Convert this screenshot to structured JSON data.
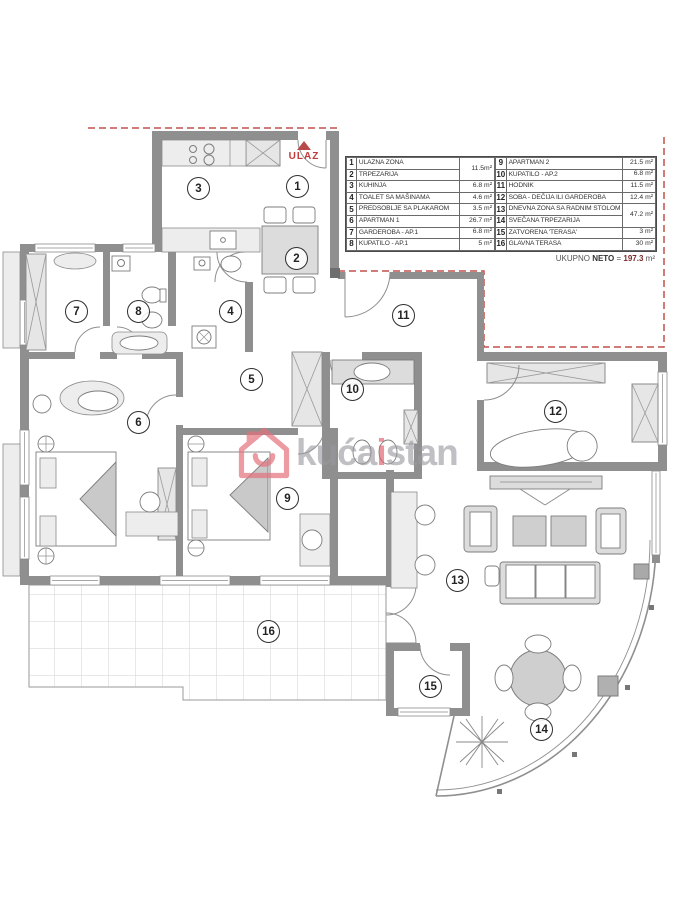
{
  "plan": {
    "ulaz_label": "ULAZ",
    "watermark": {
      "part1": "kuća",
      "part2": "i",
      "part3": "stan"
    },
    "rooms": [
      {
        "num": "1",
        "x": 297,
        "y": 186
      },
      {
        "num": "2",
        "x": 296,
        "y": 258
      },
      {
        "num": "3",
        "x": 198,
        "y": 188
      },
      {
        "num": "4",
        "x": 230,
        "y": 311
      },
      {
        "num": "5",
        "x": 251,
        "y": 379
      },
      {
        "num": "6",
        "x": 138,
        "y": 422
      },
      {
        "num": "7",
        "x": 76,
        "y": 311
      },
      {
        "num": "8",
        "x": 138,
        "y": 311
      },
      {
        "num": "9",
        "x": 287,
        "y": 498
      },
      {
        "num": "10",
        "x": 352,
        "y": 389
      },
      {
        "num": "11",
        "x": 403,
        "y": 315
      },
      {
        "num": "12",
        "x": 555,
        "y": 411
      },
      {
        "num": "13",
        "x": 457,
        "y": 580
      },
      {
        "num": "14",
        "x": 541,
        "y": 729
      },
      {
        "num": "15",
        "x": 430,
        "y": 686
      },
      {
        "num": "16",
        "x": 268,
        "y": 631
      }
    ]
  },
  "legend": {
    "left": [
      {
        "num": "1",
        "name": "ULAZNA ZONA",
        "area": "11.5m²",
        "rowspan": 2
      },
      {
        "num": "2",
        "name": "TRPEZARIJA",
        "area": null
      },
      {
        "num": "3",
        "name": "KUHINJA",
        "area": "6.8 m²"
      },
      {
        "num": "4",
        "name": "TOALET SA MAŠINAMA",
        "area": "4.6 m²"
      },
      {
        "num": "5",
        "name": "PREDSOBLJE SA PLAKAROM",
        "area": "3.5 m²"
      },
      {
        "num": "6",
        "name": "APARTMAN 1",
        "area": "26.7 m²"
      },
      {
        "num": "7",
        "name": "GARDEROBA - AP.1",
        "area": "6.8 m²"
      },
      {
        "num": "8",
        "name": "KUPATILO - AP.1",
        "area": "5 m²"
      }
    ],
    "right": [
      {
        "num": "9",
        "name": "APARTMAN 2",
        "area": "21.5 m²"
      },
      {
        "num": "10",
        "name": "KUPATILO - AP.2",
        "area": "6.8 m²"
      },
      {
        "num": "11",
        "name": "HODNIK",
        "area": "11.5 m²"
      },
      {
        "num": "12",
        "name": "SOBA - DEČIJA ILI GARDEROBA",
        "area": "12.4 m²"
      },
      {
        "num": "13",
        "name": "DNEVNA ZONA SA RADNIM STOLOM",
        "area": "47.2 m²",
        "rowspan": 2
      },
      {
        "num": "14",
        "name": "SVEČANA TRPEZARIJA",
        "area": null
      },
      {
        "num": "15",
        "name": "ZATVORENA 'TERASA'",
        "area": "3 m²"
      },
      {
        "num": "16",
        "name": "GLAVNA TERASA",
        "area": "30 m²"
      }
    ],
    "total": {
      "ukupno": "UKUPNO",
      "neto": "NETO",
      "eq": "=",
      "value": "197.3",
      "unit": "m²"
    }
  },
  "colors": {
    "wall_gray": "#8f8f8f",
    "furniture_gray": "#dcdcdc",
    "accent_red": "#c0504d",
    "watermark_pink": "#e05b6a",
    "watermark_gray": "#97979f"
  }
}
